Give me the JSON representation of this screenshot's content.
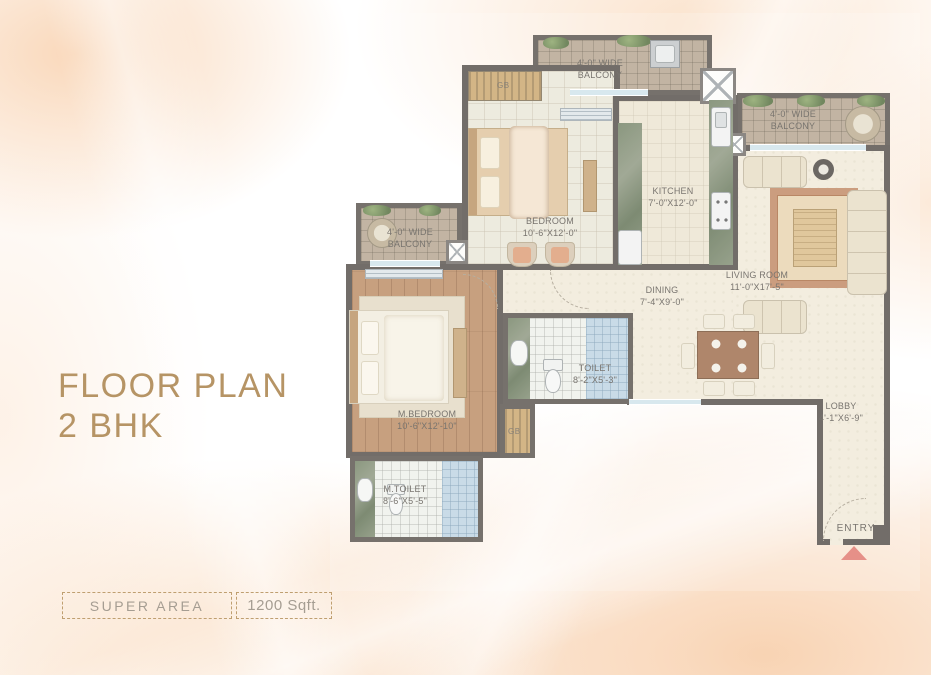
{
  "title": {
    "line1": "FLOOR PLAN",
    "line2": "2 BHK"
  },
  "footer": {
    "label": "SUPER AREA",
    "value": "1200 Sqft."
  },
  "plan": {
    "balcony_top": {
      "l1": "4'-0\" WIDE",
      "l2": "BALCONY"
    },
    "balcony_right": {
      "l1": "4'-0\" WIDE",
      "l2": "BALCONY"
    },
    "balcony_left": {
      "l1": "4'-0\" WIDE",
      "l2": "BALCONY"
    },
    "bedroom": {
      "name": "BEDROOM",
      "dims": "10'-6\"X12'-0\""
    },
    "kitchen": {
      "name": "KITCHEN",
      "dims": "7'-0\"X12'-0\""
    },
    "living_room": {
      "name": "LIVING ROOM",
      "dims": "11'-0\"X17'-5\""
    },
    "dining": {
      "name": "DINING",
      "dims": "7'-4\"X9'-0\""
    },
    "toilet": {
      "name": "TOILET",
      "dims": "8'-2\"X5'-3\""
    },
    "m_bedroom": {
      "name": "M.BEDROOM",
      "dims": "10'-6\"X12'-10\""
    },
    "m_toilet": {
      "name": "M.TOILET",
      "dims": "8'-6\"X5'-5\""
    },
    "lobby": {
      "name": "LOBBY",
      "dims": "4'-1\"X6'-9\""
    },
    "entry_label": "ENTRY",
    "wardrobe_label": "GB"
  },
  "colors": {
    "wall": "#4f4944",
    "entry_arrow": "#e0756b",
    "title_text": "#b69465",
    "plan_text": "#57524b",
    "footer_border": "#bf9f70",
    "footer_text": "#a59d92",
    "wood_floor": "#b9895f",
    "cream_floor": "#f0e9d8",
    "counter_green": "#6e7e60",
    "shower_blue": "#bcd2e2"
  }
}
